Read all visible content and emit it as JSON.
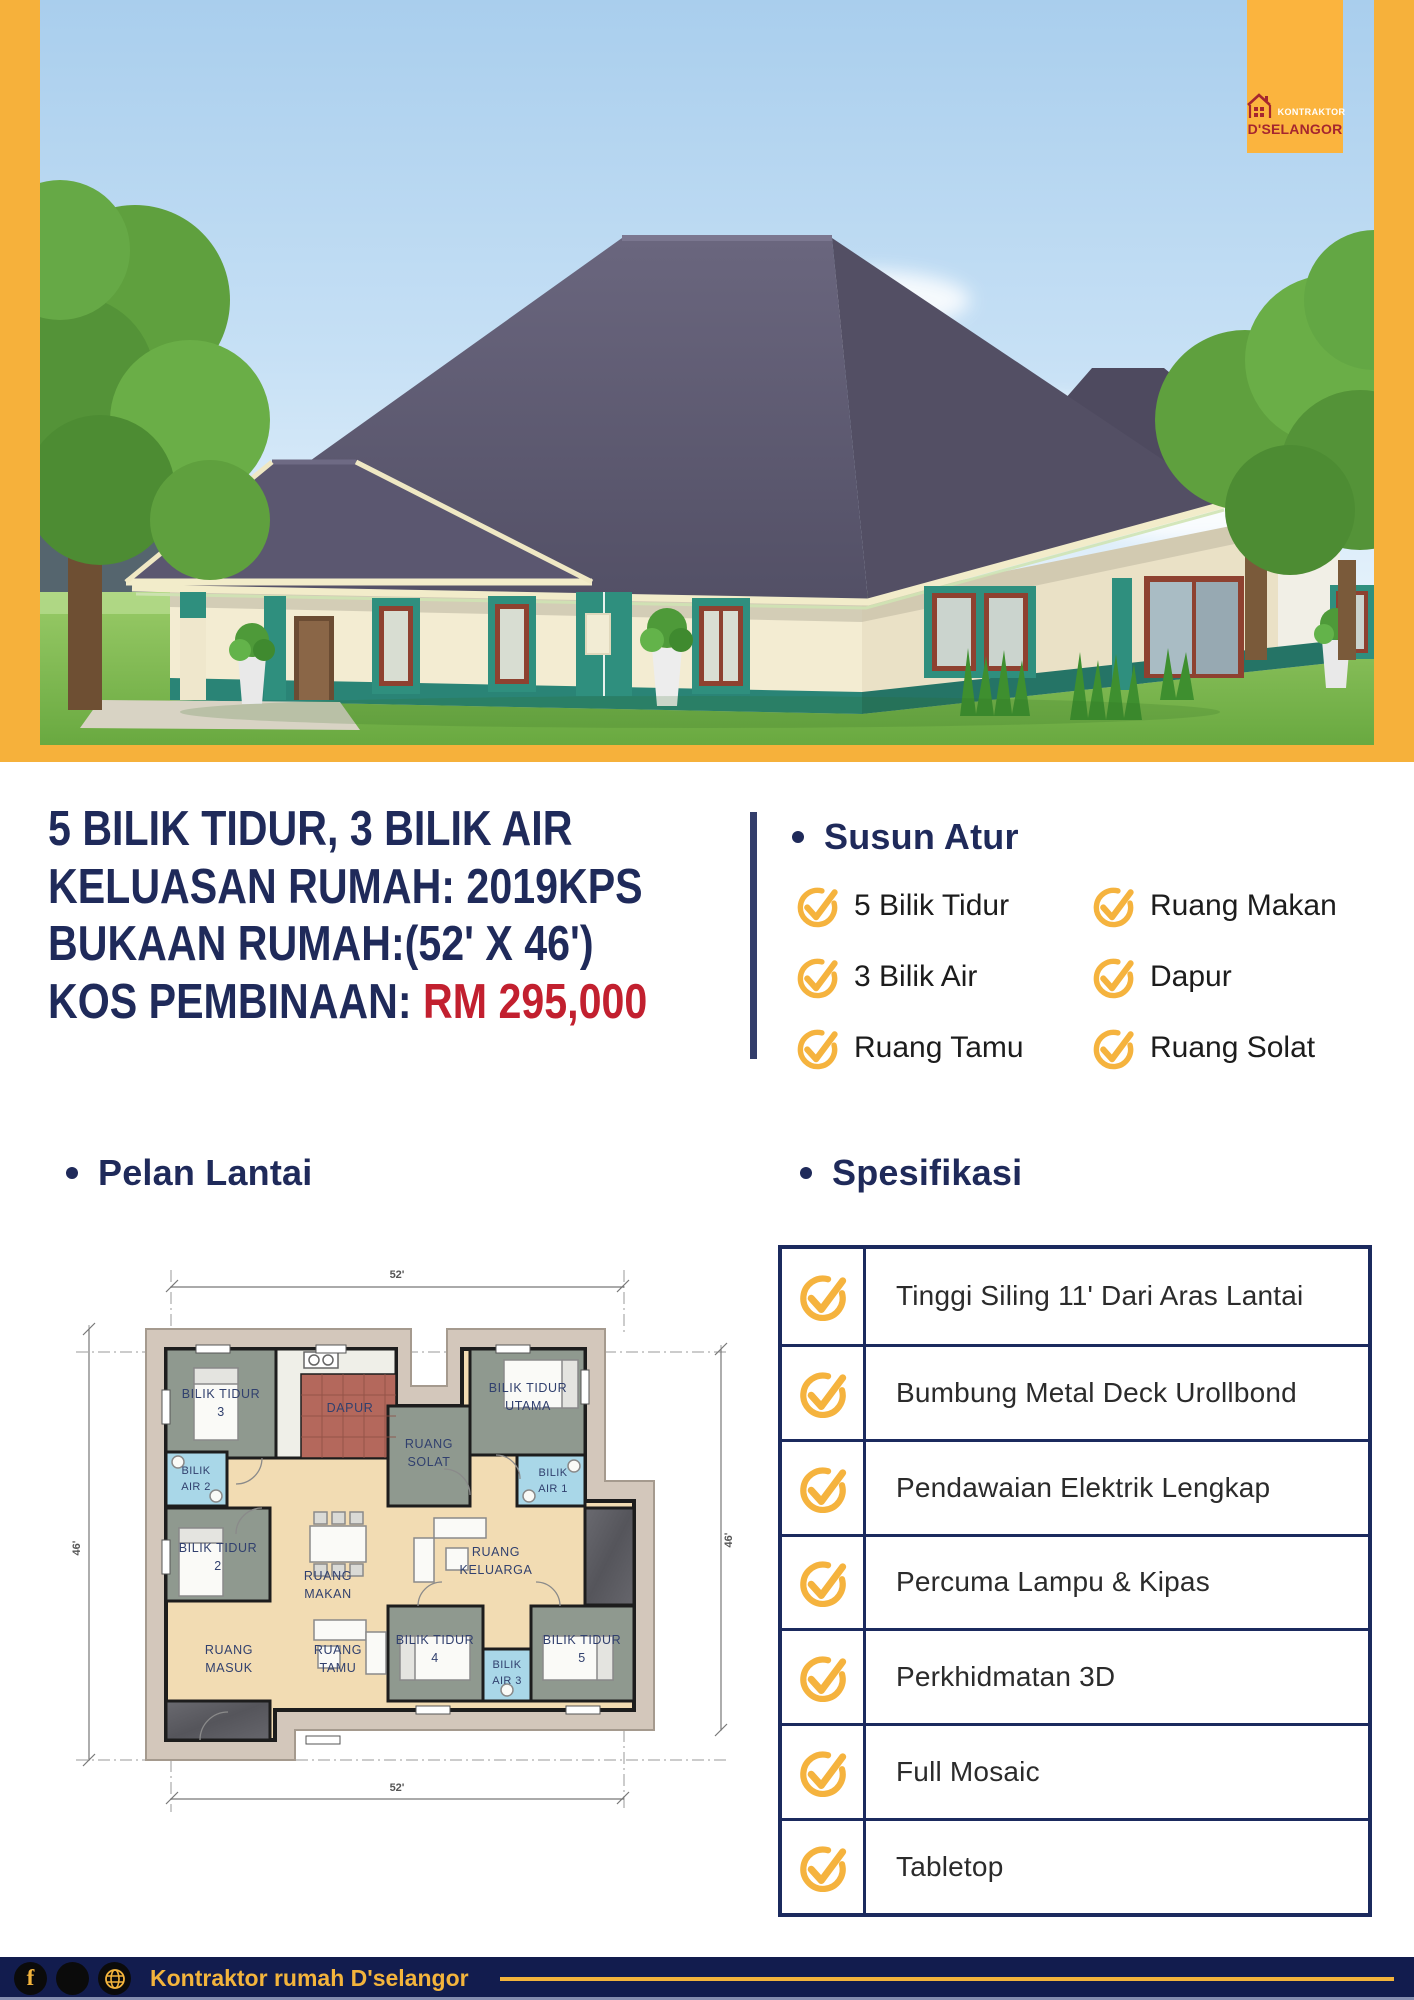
{
  "brand": {
    "logo_line1": "KONTRAKTOR",
    "logo_line2": "D'SELANGOR"
  },
  "headline": {
    "line1": "5 BILIK TIDUR, 3 BILIK AIR",
    "line2": "KELUASAN RUMAH: 2019KPS",
    "line3": "BUKAAN RUMAH:(52' X 46')",
    "line4_label": "KOS PEMBINAAN:",
    "line4_price": "RM 295,000"
  },
  "susun_atur": {
    "title": "Susun Atur",
    "col1": [
      "5 Bilik Tidur",
      "3 Bilik Air",
      "Ruang Tamu"
    ],
    "col2": [
      "Ruang Makan",
      "Dapur",
      "Ruang Solat"
    ]
  },
  "pelan_lantai": {
    "title": "Pelan Lantai",
    "dim_top": "52'",
    "dim_bottom": "52'",
    "dim_left": "46'",
    "dim_right": "46'",
    "rooms": [
      {
        "l1": "BILIK TIDUR",
        "l2": "3"
      },
      {
        "l1": "DAPUR",
        "l2": ""
      },
      {
        "l1": "RUANG",
        "l2": "SOLAT"
      },
      {
        "l1": "BILIK TIDUR",
        "l2": "UTAMA"
      },
      {
        "l1": "BILIK",
        "l2": "AIR 2"
      },
      {
        "l1": "BILIK",
        "l2": "AIR 1"
      },
      {
        "l1": "BILIK TIDUR",
        "l2": "2"
      },
      {
        "l1": "RUANG",
        "l2": "MAKAN"
      },
      {
        "l1": "RUANG",
        "l2": "KELUARGA"
      },
      {
        "l1": "RUANG",
        "l2": "MASUK"
      },
      {
        "l1": "RUANG",
        "l2": "TAMU"
      },
      {
        "l1": "BILIK TIDUR",
        "l2": "4"
      },
      {
        "l1": "BILIK",
        "l2": "AIR 3"
      },
      {
        "l1": "BILIK TIDUR",
        "l2": "5"
      }
    ]
  },
  "spesifikasi": {
    "title": "Spesifikasi",
    "items": [
      "Tinggi Siling 11' Dari Aras Lantai",
      "Bumbung Metal Deck Urollbond",
      "Pendawaian Elektrik Lengkap",
      "Percuma Lampu & Kipas",
      "Perkhidmatan 3D",
      "Full Mosaic",
      "Tabletop"
    ]
  },
  "footer": {
    "brand": "Kontraktor rumah D'selangor",
    "icons": [
      "facebook-icon",
      "social-circle-icon",
      "globe-icon"
    ]
  },
  "colors": {
    "frame_yellow": "#F6B13B",
    "navy": "#1F2A5A",
    "price_red": "#C2202F",
    "check_amber": "#F5B33E",
    "table_border": "#1B2A5E",
    "footer_bg": "#121C4E",
    "logo_red": "#A5262F"
  }
}
